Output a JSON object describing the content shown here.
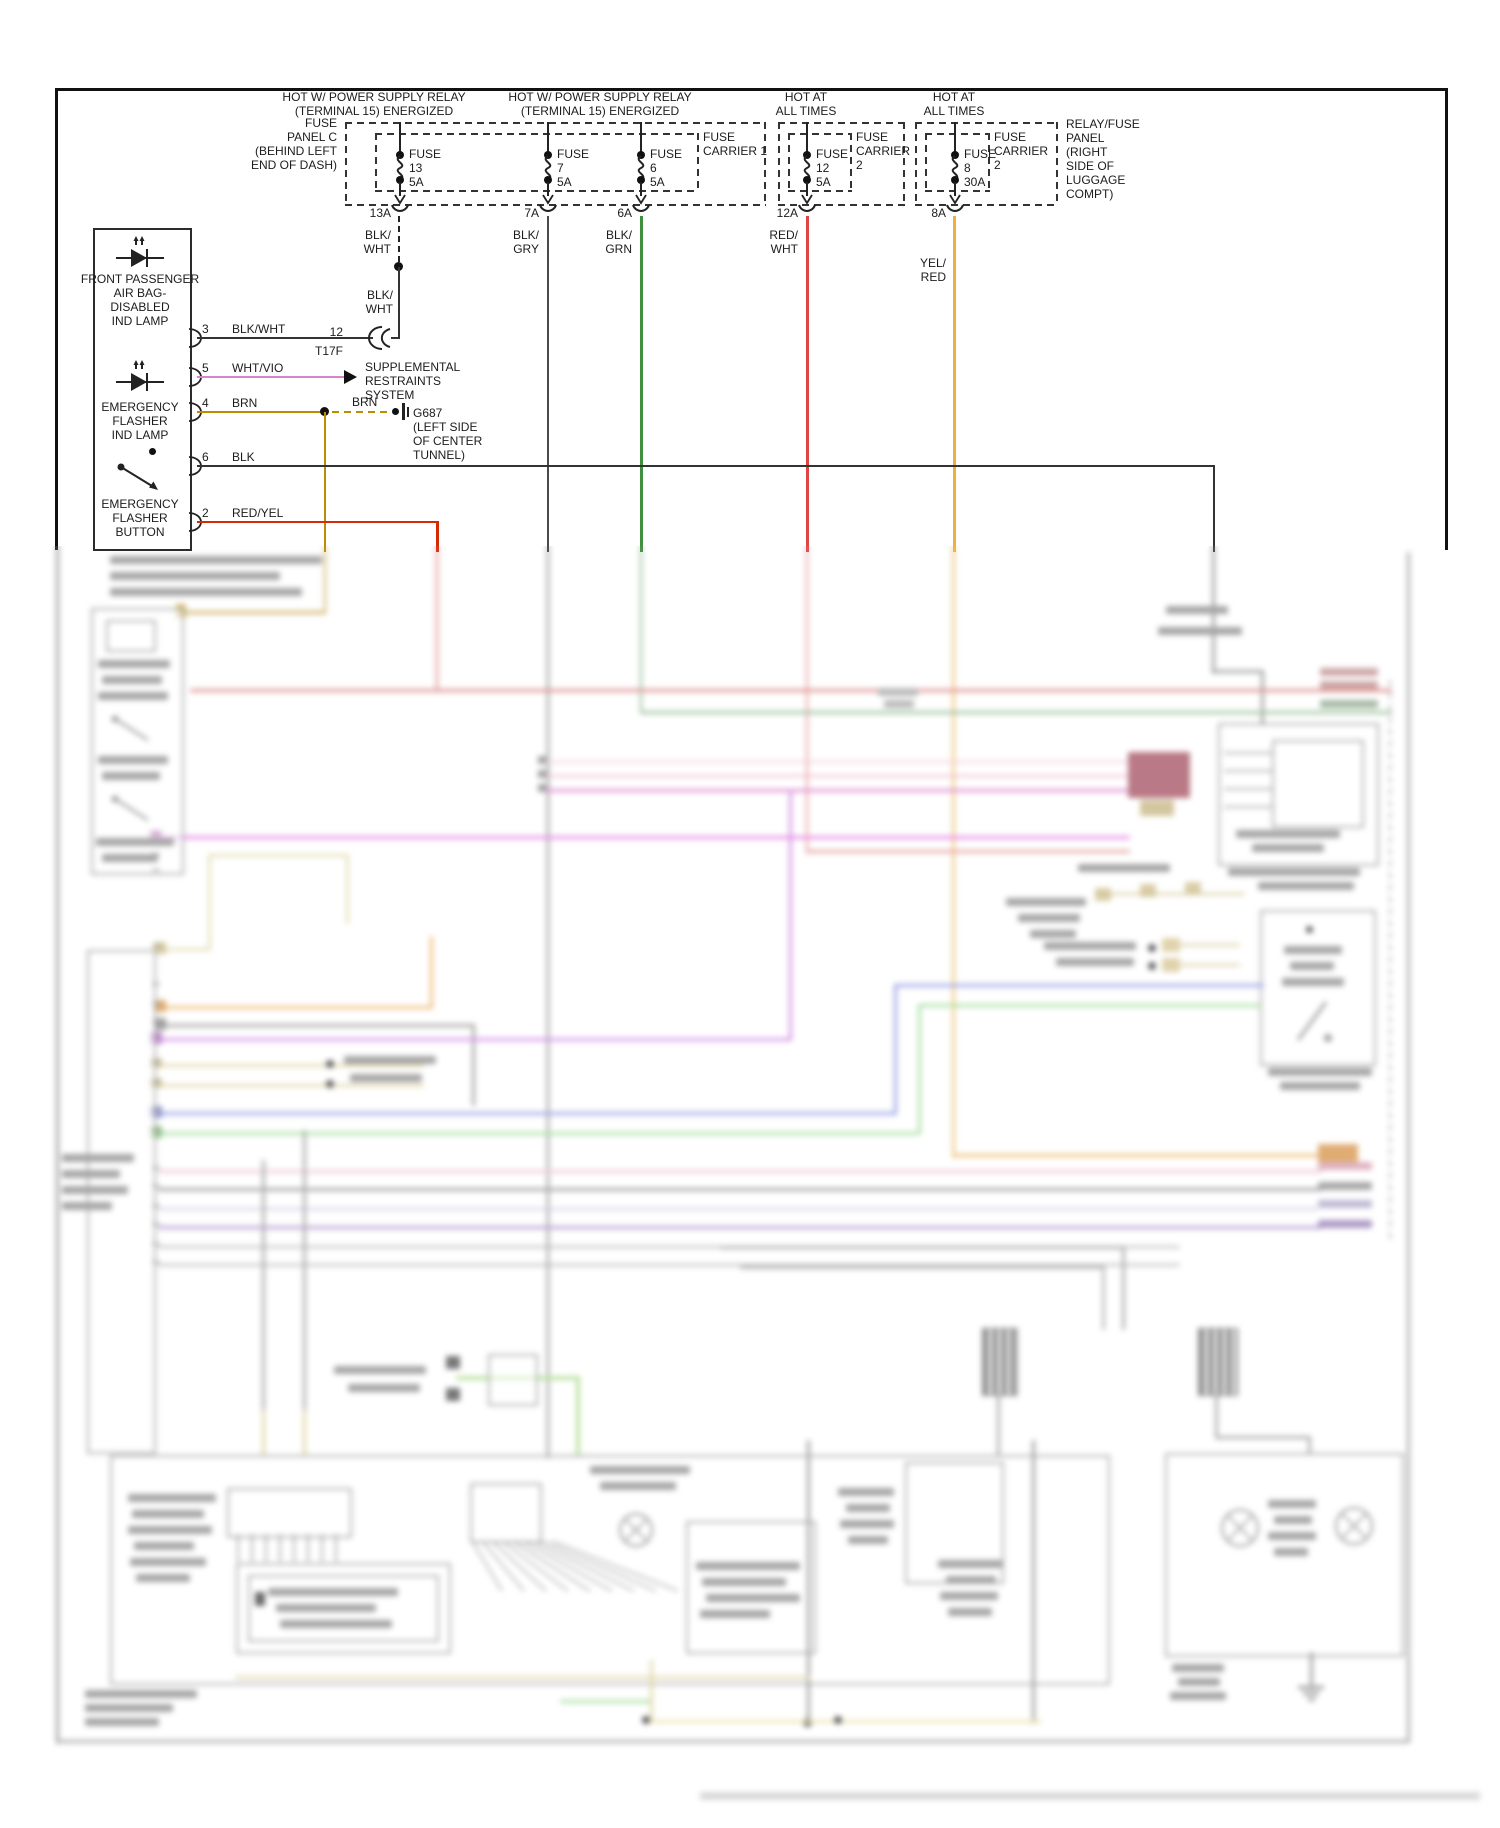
{
  "headers": [
    {
      "l1": "HOT W/ POWER SUPPLY RELAY",
      "l2": "(TERMINAL 15) ENERGIZED"
    },
    {
      "l1": "HOT W/ POWER SUPPLY RELAY",
      "l2": "(TERMINAL 15) ENERGIZED"
    },
    {
      "l1": "HOT AT",
      "l2": "ALL TIMES"
    },
    {
      "l1": "HOT AT",
      "l2": "ALL TIMES"
    }
  ],
  "panel_c": [
    "FUSE",
    "PANEL C",
    "(BEHIND LEFT",
    "END OF DASH)"
  ],
  "carrier1": [
    "FUSE",
    "CARRIER 1"
  ],
  "carrier2a": [
    "FUSE",
    "CARRIER",
    "2"
  ],
  "carrier2b": [
    "FUSE",
    "CARRIER",
    "2"
  ],
  "relay_panel": [
    "RELAY/FUSE",
    "PANEL",
    "(RIGHT",
    "SIDE OF",
    "LUGGAGE",
    "COMPT)"
  ],
  "fuses": [
    {
      "label": "FUSE",
      "num": "13",
      "amp": "5A",
      "out": "13A",
      "w1": "BLK/",
      "w2": "WHT"
    },
    {
      "label": "FUSE",
      "num": "7",
      "amp": "5A",
      "out": "7A",
      "w1": "BLK/",
      "w2": "GRY"
    },
    {
      "label": "FUSE",
      "num": "6",
      "amp": "5A",
      "out": "6A",
      "w1": "BLK/",
      "w2": "GRN"
    },
    {
      "label": "FUSE",
      "num": "12",
      "amp": "5A",
      "out": "12A",
      "w1": "RED/",
      "w2": "WHT"
    },
    {
      "label": "FUSE",
      "num": "8",
      "amp": "30A",
      "out": "8A",
      "w1": "YEL/",
      "w2": "RED"
    }
  ],
  "blkwht_repeat": {
    "l1": "BLK/",
    "l2": "WHT"
  },
  "left_box": {
    "lamp1": [
      "FRONT PASSENGER",
      "AIR BAG-",
      "DISABLED",
      "IND LAMP"
    ],
    "lamp2": [
      "EMERGENCY",
      "FLASHER",
      "IND LAMP"
    ],
    "button": [
      "EMERGENCY",
      "FLASHER",
      "BUTTON"
    ]
  },
  "pins": [
    {
      "num": "3",
      "wire": "BLK/WHT"
    },
    {
      "num": "5",
      "wire": "WHT/VIO"
    },
    {
      "num": "4",
      "wire": "BRN"
    },
    {
      "num": "6",
      "wire": "BLK"
    },
    {
      "num": "2",
      "wire": "RED/YEL"
    }
  ],
  "connector": {
    "num": "12",
    "name": "T17F"
  },
  "srs": [
    "SUPPLEMENTAL",
    "RESTRAINTS",
    "SYSTEM"
  ],
  "ground": {
    "wire": "BRN",
    "name": "G687",
    "loc": [
      "(LEFT SIDE",
      "OF CENTER",
      "TUNNEL)"
    ]
  },
  "colors": {
    "blk": "#3a3a3a",
    "blk_gry": "#4a4a4a",
    "blk_grn": "#3f8f3f",
    "red_wht": "#e04545",
    "yel_red": "#eeb03c",
    "wht_vio": "#d883cf",
    "brn": "#bb8d05",
    "red_yel": "#d52b05"
  }
}
